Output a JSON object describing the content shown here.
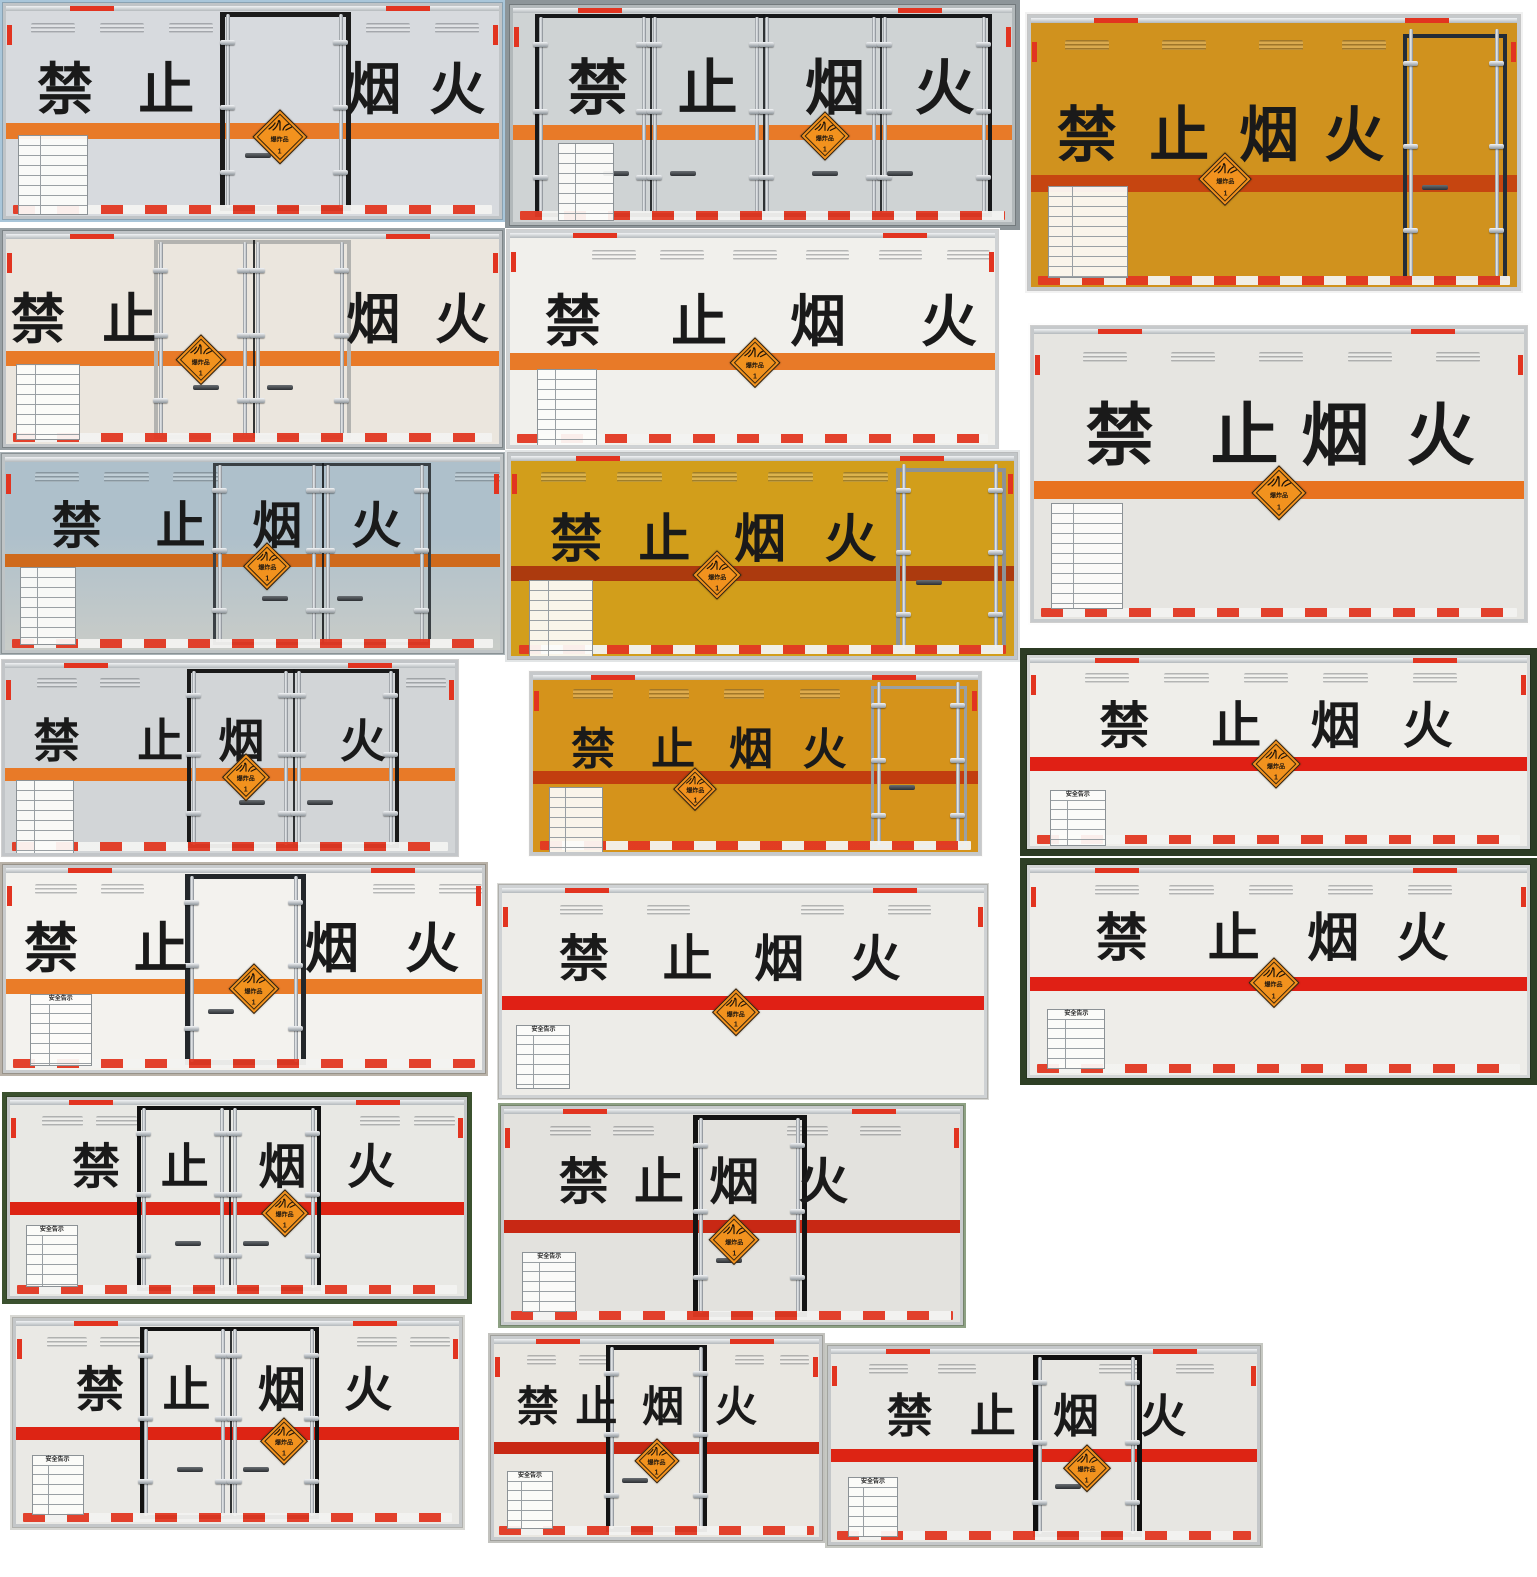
{
  "collage": {
    "main_text": {
      "full": "禁止烟火",
      "chars": [
        "禁",
        "止",
        "烟",
        "火"
      ]
    },
    "placard": {
      "label": "爆炸品",
      "class_no": "1",
      "bg": "#f2921e",
      "border": "#2b2115"
    },
    "plate_title": "安全告示",
    "colors": {
      "stripe_orange": "#e87a28",
      "stripe_red": "#e02015",
      "stripe_dark_red": "#c23e0f",
      "reflector_red": "#e23822",
      "reflector_white": "#f3f3f1",
      "placard_orange": "#f2921e"
    },
    "trucks": [
      {
        "x": 0,
        "y": 0,
        "w": 505,
        "h": 222,
        "bg": "#a9c6da",
        "inset": 3,
        "frame": "#c0c4c7",
        "body": "#d7dade",
        "stripeY": 0.555,
        "stripeH": 16,
        "stripeC": "#e87a28",
        "charY": 0.4,
        "charS": 56,
        "charX": [
          0.12,
          0.325,
          0.745,
          0.915
        ],
        "door": {
          "t": "s",
          "x": 0.435,
          "w": 0.265,
          "f": "#1b1b1b",
          "fw": 5
        },
        "diaX": 0.555,
        "diaY": 0.625,
        "diaS": 56,
        "plateX": 0.025,
        "plateY": 0.615,
        "plateW": 70,
        "plateH": 80,
        "plateT": 0,
        "vents": [
          0.05,
          0.19,
          0.33,
          0.73,
          0.87
        ],
        "railRed": 1,
        "reflect": 1
      },
      {
        "x": 505,
        "y": 0,
        "w": 515,
        "h": 230,
        "bg": "#8d9599",
        "inset": 5,
        "frame": "#b2b8ba",
        "body": "#cfd3d4",
        "stripeY": 0.545,
        "stripeH": 15,
        "stripeC": "#e87a28",
        "charY": 0.38,
        "charS": 60,
        "charX": [
          0.17,
          0.39,
          0.645,
          0.865
        ],
        "door": {
          "t": "p4",
          "x": 0.045,
          "w": 0.915,
          "f": "#17181a",
          "fw": 4,
          "seams": [
            0.275,
            0.5,
            0.735
          ]
        },
        "diaX": 0.625,
        "diaY": 0.6,
        "diaS": 50,
        "plateX": 0.09,
        "plateY": 0.63,
        "plateW": 56,
        "plateH": 78,
        "plateT": 0,
        "vents": null,
        "railRed": 1,
        "reflect": 1
      },
      {
        "x": 1025,
        "y": 12,
        "w": 498,
        "h": 281,
        "bg": "#f2f2f2",
        "inset": 3,
        "frame": "#c6c9cb",
        "body": "#d0921e",
        "stripeY": 0.585,
        "stripeH": 17,
        "stripeC": "#c64510",
        "charY": 0.44,
        "charS": 60,
        "charX": [
          0.115,
          0.305,
          0.49,
          0.665
        ],
        "door": {
          "t": "r",
          "x": 0.765,
          "w": 0.215,
          "f": "#232c37",
          "fw": 4
        },
        "diaX": 0.4,
        "diaY": 0.6,
        "diaS": 54,
        "plateX": 0.035,
        "plateY": 0.625,
        "plateW": 80,
        "plateH": 92,
        "plateT": 0,
        "vents": [
          0.07,
          0.27,
          0.47,
          0.64
        ],
        "railRed": 1,
        "reflect": 1
      },
      {
        "x": 0,
        "y": 228,
        "w": 505,
        "h": 222,
        "bg": "#99a1a5",
        "inset": 3,
        "frame": "#c0c4c7",
        "body": "#ebe6de",
        "stripeY": 0.555,
        "stripeH": 15,
        "stripeC": "#e87a28",
        "charY": 0.41,
        "charS": 54,
        "charX": [
          0.065,
          0.25,
          0.745,
          0.925
        ],
        "door": {
          "t": "d",
          "x": 0.3,
          "w": 0.4,
          "f": "#b3b3b0",
          "fw": 4
        },
        "diaX": 0.395,
        "diaY": 0.6,
        "diaS": 52,
        "plateX": 0.02,
        "plateY": 0.62,
        "plateW": 64,
        "plateH": 76,
        "plateT": 0,
        "vents": null,
        "railRed": 1,
        "reflect": 1
      },
      {
        "x": 505,
        "y": 228,
        "w": 495,
        "h": 222,
        "bg": "#fdfdfd",
        "inset": 2,
        "frame": "#cfd2d4",
        "body": "#f1f0ec",
        "stripeY": 0.565,
        "stripeH": 17,
        "stripeC": "#e87a28",
        "charY": 0.42,
        "charS": 56,
        "charX": [
          0.13,
          0.39,
          0.635,
          0.905
        ],
        "door": null,
        "diaX": 0.505,
        "diaY": 0.615,
        "diaS": 52,
        "plateX": 0.055,
        "plateY": 0.64,
        "plateW": 60,
        "plateH": 82,
        "plateT": 0,
        "vents": [
          0.17,
          0.31,
          0.46,
          0.61,
          0.76,
          0.9
        ],
        "railRed": 1,
        "reflect": 1
      },
      {
        "x": 1028,
        "y": 323,
        "w": 502,
        "h": 302,
        "bg": "#fdfdfd",
        "inset": 3,
        "frame": "#c6c9cb",
        "body": "#e6e5e1",
        "stripeY": 0.525,
        "stripeH": 18,
        "stripeC": "#e8721f",
        "charY": 0.37,
        "charS": 68,
        "charX": [
          0.175,
          0.43,
          0.615,
          0.83
        ],
        "door": null,
        "diaX": 0.5,
        "diaY": 0.565,
        "diaS": 56,
        "plateX": 0.035,
        "plateY": 0.6,
        "plateW": 72,
        "plateH": 106,
        "plateT": 0,
        "vents": [
          0.1,
          0.28,
          0.46,
          0.64,
          0.82
        ],
        "railRed": 1,
        "reflect": 1
      },
      {
        "x": 0,
        "y": 452,
        "w": 505,
        "h": 203,
        "bg": "#a9b2b6",
        "inset": 2,
        "frame": "#bfc4c6",
        "body": "#aec0cb",
        "body2": "#c9ccc8",
        "stripeY": 0.5,
        "stripeH": 13,
        "stripeC": "#cf6a1c",
        "charY": 0.355,
        "charS": 50,
        "charX": [
          0.145,
          0.355,
          0.55,
          0.75
        ],
        "door": {
          "t": "d",
          "x": 0.42,
          "w": 0.44,
          "f": "#3a4044",
          "fw": 3
        },
        "diaX": 0.53,
        "diaY": 0.565,
        "diaS": 48,
        "plateX": 0.03,
        "plateY": 0.57,
        "plateW": 56,
        "plateH": 78,
        "plateT": 0,
        "vents": [
          0.06,
          0.2,
          0.34,
          0.91
        ],
        "railRed": 0,
        "reflect": 1
      },
      {
        "x": 505,
        "y": 450,
        "w": 515,
        "h": 212,
        "bg": "#e2e5e6",
        "inset": 3,
        "frame": "#c2c6c8",
        "body": "#d29e1b",
        "stripeY": 0.55,
        "stripeH": 15,
        "stripeC": "#ac3a0e",
        "charY": 0.42,
        "charS": 52,
        "charX": [
          0.13,
          0.305,
          0.495,
          0.675
        ],
        "door": {
          "t": "r",
          "x": 0.765,
          "w": 0.22,
          "f": "#8d9297",
          "fw": 4
        },
        "diaX": 0.41,
        "diaY": 0.595,
        "diaS": 50,
        "plateX": 0.035,
        "plateY": 0.62,
        "plateW": 64,
        "plateH": 78,
        "plateT": 0,
        "vents": [
          0.06,
          0.21,
          0.36,
          0.51,
          0.66
        ],
        "railRed": 1,
        "reflect": 1
      },
      {
        "x": 0,
        "y": 658,
        "w": 460,
        "h": 200,
        "bg": "#fdfdfd",
        "inset": 2,
        "frame": "#c2c5c8",
        "body": "#d2d5d7",
        "stripeY": 0.55,
        "stripeH": 13,
        "stripeC": "#e87a28",
        "charY": 0.41,
        "charS": 46,
        "charX": [
          0.115,
          0.345,
          0.525,
          0.795
        ],
        "door": {
          "t": "d",
          "x": 0.405,
          "w": 0.47,
          "f": "#191919",
          "fw": 4
        },
        "diaX": 0.535,
        "diaY": 0.6,
        "diaS": 48,
        "plateX": 0.025,
        "plateY": 0.615,
        "plateW": 58,
        "plateH": 74,
        "plateT": 0,
        "vents": [
          0.07,
          0.21,
          0.89
        ],
        "railRed": 1,
        "reflect": 1
      },
      {
        "x": 528,
        "y": 670,
        "w": 455,
        "h": 187,
        "bg": "#fbfbfa",
        "inset": 2,
        "frame": "#c6c9cb",
        "body": "#d5931b",
        "stripeY": 0.545,
        "stripeH": 13,
        "stripeC": "#c23e0f",
        "charY": 0.425,
        "charS": 44,
        "charX": [
          0.135,
          0.315,
          0.49,
          0.655
        ],
        "door": {
          "t": "r",
          "x": 0.76,
          "w": 0.215,
          "f": "#9aa0a5",
          "fw": 3
        },
        "diaX": 0.365,
        "diaY": 0.645,
        "diaS": 44,
        "plateX": 0.035,
        "plateY": 0.63,
        "plateW": 54,
        "plateH": 70,
        "plateT": 0,
        "vents": [
          0.09,
          0.26,
          0.43,
          0.6
        ],
        "railRed": 1,
        "reflect": 1
      },
      {
        "x": 1020,
        "y": 648,
        "w": 517,
        "h": 208,
        "bg": "#2c3b24",
        "inset": 7,
        "frame": "#d4d6d6",
        "body": "#efeeea",
        "stripeY": 0.525,
        "stripeH": 14,
        "stripeC": "#e02015",
        "charY": 0.36,
        "charS": 50,
        "charX": [
          0.19,
          0.415,
          0.615,
          0.8
        ],
        "door": null,
        "diaX": 0.495,
        "diaY": 0.565,
        "diaS": 50,
        "plateX": 0.04,
        "plateY": 0.7,
        "plateW": 56,
        "plateH": 56,
        "plateT": 1,
        "vents": [
          0.11,
          0.27,
          0.43,
          0.59,
          0.77
        ],
        "railRed": 1,
        "reflect": 1
      },
      {
        "x": 1020,
        "y": 858,
        "w": 517,
        "h": 227,
        "bg": "#2e3f25",
        "inset": 7,
        "frame": "#d4d6d6",
        "body": "#eeede9",
        "stripeY": 0.525,
        "stripeH": 14,
        "stripeC": "#e02015",
        "charY": 0.345,
        "charS": 52,
        "charX": [
          0.185,
          0.41,
          0.61,
          0.79
        ],
        "door": null,
        "diaX": 0.49,
        "diaY": 0.555,
        "diaS": 52,
        "plateX": 0.035,
        "plateY": 0.68,
        "plateW": 58,
        "plateH": 60,
        "plateT": 1,
        "vents": [
          0.13,
          0.28,
          0.44,
          0.6,
          0.76
        ],
        "railRed": 1,
        "reflect": 1
      },
      {
        "x": 0,
        "y": 862,
        "w": 488,
        "h": 214,
        "bg": "#b9b2a8",
        "inset": 3,
        "frame": "#c8cbcd",
        "body": "#f3f2ee",
        "stripeY": 0.55,
        "stripeH": 15,
        "stripeC": "#ea7c28",
        "charY": 0.4,
        "charS": 54,
        "charX": [
          0.095,
          0.325,
          0.685,
          0.895
        ],
        "door": {
          "t": "s",
          "x": 0.375,
          "w": 0.255,
          "f": "#23272a",
          "fw": 5
        },
        "diaX": 0.52,
        "diaY": 0.6,
        "diaS": 52,
        "plateX": 0.05,
        "plateY": 0.625,
        "plateW": 62,
        "plateH": 72,
        "plateT": 1,
        "vents": [
          0.06,
          0.2,
          0.77,
          0.91
        ],
        "railRed": 1,
        "reflect": 1
      },
      {
        "x": 497,
        "y": 883,
        "w": 492,
        "h": 217,
        "bg": "#d7d7d3",
        "inset": 2,
        "frame": "#cfd2d4",
        "body": "#edece8",
        "stripeY": 0.52,
        "stripeH": 14,
        "stripeC": "#e02015",
        "charY": 0.345,
        "charS": 50,
        "charX": [
          0.17,
          0.385,
          0.575,
          0.775
        ],
        "door": null,
        "diaX": 0.485,
        "diaY": 0.6,
        "diaS": 48,
        "plateX": 0.03,
        "plateY": 0.66,
        "plateW": 54,
        "plateH": 64,
        "plateT": 1,
        "vents": [
          0.12,
          0.3,
          0.62,
          0.8
        ],
        "railRed": 1,
        "reflect": 0
      },
      {
        "x": 2,
        "y": 1092,
        "w": 470,
        "h": 212,
        "bg": "#3b512f",
        "inset": 5,
        "frame": "#c4c7c9",
        "body": "#e8e8e4",
        "stripeY": 0.52,
        "stripeH": 13,
        "stripeC": "#dd2414",
        "charY": 0.345,
        "charS": 48,
        "charX": [
          0.19,
          0.385,
          0.6,
          0.795
        ],
        "door": {
          "t": "d",
          "x": 0.28,
          "w": 0.405,
          "f": "#121212",
          "fw": 4
        },
        "diaX": 0.605,
        "diaY": 0.575,
        "diaS": 48,
        "plateX": 0.035,
        "plateY": 0.64,
        "plateW": 52,
        "plateH": 62,
        "plateT": 1,
        "vents": [
          0.07,
          0.19,
          0.77,
          0.89
        ],
        "railRed": 1,
        "reflect": 1
      },
      {
        "x": 498,
        "y": 1103,
        "w": 468,
        "h": 225,
        "bg": "#8ea184",
        "inset": 3,
        "frame": "#c8cbcd",
        "body": "#e3e2de",
        "stripeY": 0.52,
        "stripeH": 13,
        "stripeC": "#c82814",
        "charY": 0.345,
        "charS": 50,
        "charX": [
          0.175,
          0.34,
          0.505,
          0.7
        ],
        "door": {
          "t": "s",
          "x": 0.415,
          "w": 0.25,
          "f": "#141414",
          "fw": 5
        },
        "diaX": 0.505,
        "diaY": 0.615,
        "diaS": 52,
        "plateX": 0.04,
        "plateY": 0.67,
        "plateW": 54,
        "plateH": 60,
        "plateT": 1,
        "vents": [
          0.1,
          0.24,
          0.62,
          0.78
        ],
        "railRed": 1,
        "reflect": 1
      },
      {
        "x": 10,
        "y": 1315,
        "w": 455,
        "h": 215,
        "bg": "#d8d8d4",
        "inset": 3,
        "frame": "#c4c7c9",
        "body": "#eae9e5",
        "stripeY": 0.52,
        "stripeH": 13,
        "stripeC": "#dd2414",
        "charY": 0.345,
        "charS": 48,
        "charX": [
          0.19,
          0.385,
          0.6,
          0.795
        ],
        "door": {
          "t": "d",
          "x": 0.28,
          "w": 0.405,
          "f": "#121212",
          "fw": 4
        },
        "diaX": 0.605,
        "diaY": 0.59,
        "diaS": 48,
        "plateX": 0.035,
        "plateY": 0.66,
        "plateW": 52,
        "plateH": 60,
        "plateT": 1,
        "vents": [
          0.07,
          0.19,
          0.77,
          0.89
        ],
        "railRed": 1,
        "reflect": 1
      },
      {
        "x": 488,
        "y": 1333,
        "w": 337,
        "h": 210,
        "bg": "#c2c2be",
        "inset": 3,
        "frame": "#c8cbcd",
        "body": "#e9e7e1",
        "stripeY": 0.52,
        "stripeH": 12,
        "stripeC": "#c82814",
        "charY": 0.345,
        "charS": 42,
        "charX": [
          0.135,
          0.315,
          0.52,
          0.745
        ],
        "door": {
          "t": "s",
          "x": 0.345,
          "w": 0.31,
          "f": "#141414",
          "fw": 5
        },
        "diaX": 0.5,
        "diaY": 0.615,
        "diaS": 46,
        "plateX": 0.04,
        "plateY": 0.665,
        "plateW": 46,
        "plateH": 58,
        "plateT": 1,
        "vents": [
          0.1,
          0.26,
          0.74,
          0.88
        ],
        "railRed": 1,
        "reflect": 1
      },
      {
        "x": 825,
        "y": 1343,
        "w": 438,
        "h": 205,
        "bg": "#c6c8c2",
        "inset": 3,
        "frame": "#c4c7c9",
        "body": "#e7e6e2",
        "stripeY": 0.52,
        "stripeH": 13,
        "stripeC": "#dd2414",
        "charY": 0.345,
        "charS": 46,
        "charX": [
          0.185,
          0.38,
          0.575,
          0.78
        ],
        "door": {
          "t": "s",
          "x": 0.475,
          "w": 0.255,
          "f": "#101010",
          "fw": 5
        },
        "diaX": 0.6,
        "diaY": 0.615,
        "diaS": 48,
        "plateX": 0.04,
        "plateY": 0.665,
        "plateW": 50,
        "plateH": 60,
        "plateT": 1,
        "vents": [
          0.09,
          0.25,
          0.63,
          0.81
        ],
        "railRed": 1,
        "reflect": 1
      }
    ]
  }
}
